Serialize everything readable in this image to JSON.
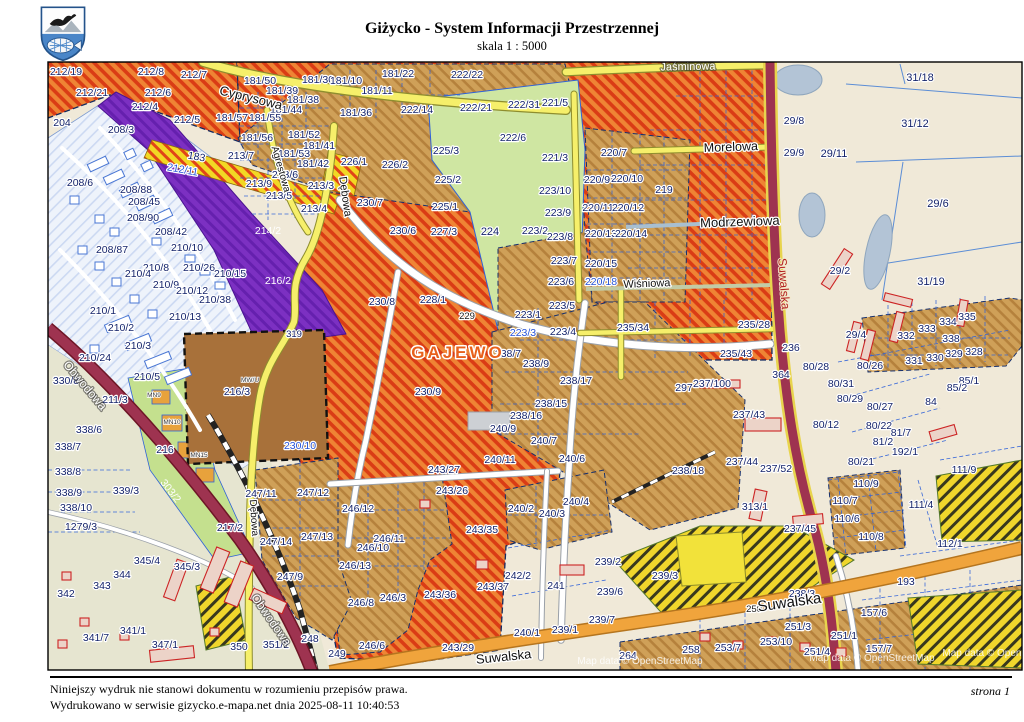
{
  "header": {
    "title": "Giżycko - System Informacji Przestrzennej",
    "subtitle": "skala 1 : 5000"
  },
  "footer": {
    "line1": "Niniejszy wydruk nie stanowi dokumentu w rozumieniu przepisów prawa.",
    "line2": "Wydrukowano w serwisie gizycko.e-mapa.net dnia 2025-08-11 10:40:53",
    "page": "strona 1"
  },
  "map": {
    "watermark": "Map data © OpenStreetMap",
    "palette": {
      "red_hatch_bg": "#ef8434",
      "red_hatch_line": "#da3c15",
      "tan_bg": "#cfa058",
      "tan_line": "#b5813c",
      "green_area": "#cfe6a2",
      "purple_area": "#7c30c2",
      "brown_area": "#a8713a",
      "beige_area": "#f0e9d8",
      "residential_area": "#eef3fb",
      "water": "#b3c4d6",
      "yellow_road": "#f6ef6a",
      "maroon_road": "#9e3350",
      "orange_road": "#f0a43c",
      "yellow_black": "#f0d62c",
      "parcel_text": "#15246b",
      "blue_text": "#2753d6",
      "locality_text": "#e8611c",
      "suwalska_text": "#b32020"
    },
    "streets": [
      {
        "t": "Cyprysowa",
        "x": 250,
        "y": 102,
        "r": 14,
        "s": 13
      },
      {
        "t": "Jaśminowa",
        "x": 688,
        "y": 70,
        "r": -1,
        "s": 11,
        "c": "stw"
      },
      {
        "t": "Morelowa",
        "x": 731,
        "y": 151,
        "r": -2,
        "s": 12.5
      },
      {
        "t": "Modrzewiowa",
        "x": 740,
        "y": 226,
        "r": -2,
        "s": 13
      },
      {
        "t": "Wiśniowa",
        "x": 647,
        "y": 287,
        "r": -2,
        "s": 11
      },
      {
        "t": "Agrestowa",
        "x": 278,
        "y": 170,
        "r": 74,
        "s": 10
      },
      {
        "t": "Dębowa",
        "x": 342,
        "y": 197,
        "r": 82,
        "s": 11
      },
      {
        "t": "Dębowa",
        "x": 251,
        "y": 518,
        "r": 86,
        "s": 10
      },
      {
        "t": "Obwodowa",
        "x": 82,
        "y": 388,
        "r": 50,
        "s": 12,
        "c": "stw"
      },
      {
        "t": "Obwodowa",
        "x": 268,
        "y": 622,
        "r": 55,
        "s": 12,
        "c": "stw"
      },
      {
        "t": "Suwalska",
        "x": 780,
        "y": 284,
        "r": 86,
        "s": 12,
        "c": "str"
      },
      {
        "t": "Suwalska",
        "x": 790,
        "y": 607,
        "r": -8,
        "s": 15
      },
      {
        "t": "Suwalska",
        "x": 504,
        "y": 661,
        "r": -6,
        "s": 13
      },
      {
        "t": "GAJEWO",
        "x": 458,
        "y": 358,
        "s": 17,
        "c": "gaj",
        "ls": 3
      }
    ],
    "codes": [
      {
        "t": "MW/U",
        "x": 250,
        "y": 382
      },
      {
        "t": "MN9",
        "x": 154,
        "y": 397
      },
      {
        "t": "MN10",
        "x": 172,
        "y": 424
      },
      {
        "t": "MN15",
        "x": 199,
        "y": 457
      }
    ],
    "parcels": [
      {
        "t": "212/19",
        "x": 66,
        "y": 75
      },
      {
        "t": "212/8",
        "x": 151,
        "y": 75
      },
      {
        "t": "212/7",
        "x": 194,
        "y": 78
      },
      {
        "t": "212/21",
        "x": 92,
        "y": 96
      },
      {
        "t": "212/6",
        "x": 158,
        "y": 96
      },
      {
        "t": "212/4",
        "x": 145,
        "y": 110
      },
      {
        "t": "212/5",
        "x": 187,
        "y": 123
      },
      {
        "t": "204",
        "x": 62,
        "y": 126
      },
      {
        "t": "208/3",
        "x": 121,
        "y": 133
      },
      {
        "t": "181/50",
        "x": 260,
        "y": 84
      },
      {
        "t": "181/39",
        "x": 282,
        "y": 94
      },
      {
        "t": "181/38",
        "x": 303,
        "y": 103
      },
      {
        "t": "181/44",
        "x": 286,
        "y": 113
      },
      {
        "t": "181/57",
        "x": 232,
        "y": 121
      },
      {
        "t": "181/55",
        "x": 265,
        "y": 121
      },
      {
        "t": "181/56",
        "x": 257,
        "y": 141
      },
      {
        "t": "181/52",
        "x": 304,
        "y": 138
      },
      {
        "t": "181/53",
        "x": 294,
        "y": 157
      },
      {
        "t": "181/41",
        "x": 319,
        "y": 149
      },
      {
        "t": "181/42",
        "x": 313,
        "y": 167
      },
      {
        "t": "181/30",
        "x": 318,
        "y": 83
      },
      {
        "t": "181/10",
        "x": 346,
        "y": 84
      },
      {
        "t": "181/11",
        "x": 377,
        "y": 94
      },
      {
        "t": "181/36",
        "x": 356,
        "y": 116
      },
      {
        "t": "181/22",
        "x": 398,
        "y": 77
      },
      {
        "t": "213/7",
        "x": 241,
        "y": 159
      },
      {
        "t": "213/6",
        "x": 285,
        "y": 178
      },
      {
        "t": "213/9",
        "x": 259,
        "y": 187
      },
      {
        "t": "213/3",
        "x": 321,
        "y": 189
      },
      {
        "t": "213/5",
        "x": 279,
        "y": 199
      },
      {
        "t": "213/4",
        "x": 314,
        "y": 212
      },
      {
        "t": "183",
        "x": 196,
        "y": 160,
        "r": 10
      },
      {
        "t": "212/11",
        "x": 182,
        "y": 173,
        "c": "blue",
        "r": 10
      },
      {
        "t": "222/22",
        "x": 467,
        "y": 78
      },
      {
        "t": "222/14",
        "x": 417,
        "y": 113
      },
      {
        "t": "222/21",
        "x": 476,
        "y": 111
      },
      {
        "t": "222/31",
        "x": 524,
        "y": 108
      },
      {
        "t": "221/5",
        "x": 555,
        "y": 106
      },
      {
        "t": "222/6",
        "x": 513,
        "y": 141
      },
      {
        "t": "221/3",
        "x": 555,
        "y": 161
      },
      {
        "t": "220/7",
        "x": 614,
        "y": 156
      },
      {
        "t": "220/9",
        "x": 597,
        "y": 183
      },
      {
        "t": "220/10",
        "x": 627,
        "y": 182
      },
      {
        "t": "219",
        "x": 664,
        "y": 193
      },
      {
        "t": "220/11",
        "x": 598,
        "y": 211
      },
      {
        "t": "220/12",
        "x": 628,
        "y": 211
      },
      {
        "t": "220/13",
        "x": 601,
        "y": 237
      },
      {
        "t": "220/14",
        "x": 631,
        "y": 237
      },
      {
        "t": "220/15",
        "x": 601,
        "y": 267
      },
      {
        "t": "220/18",
        "x": 601,
        "y": 285,
        "c": "blue"
      },
      {
        "t": "31/18",
        "x": 920,
        "y": 81,
        "s": 11
      },
      {
        "t": "31/12",
        "x": 915,
        "y": 127,
        "s": 11
      },
      {
        "t": "29/11",
        "x": 834,
        "y": 157,
        "s": 11
      },
      {
        "t": "29/8",
        "x": 794,
        "y": 124
      },
      {
        "t": "29/9",
        "x": 794,
        "y": 156
      },
      {
        "t": "29/6",
        "x": 938,
        "y": 207,
        "s": 11
      },
      {
        "t": "31/19",
        "x": 931,
        "y": 285,
        "s": 11
      },
      {
        "t": "29/2",
        "x": 840,
        "y": 274
      },
      {
        "t": "29/4",
        "x": 856,
        "y": 338
      },
      {
        "t": "226/1",
        "x": 354,
        "y": 165
      },
      {
        "t": "226/2",
        "x": 395,
        "y": 168
      },
      {
        "t": "225/3",
        "x": 446,
        "y": 154
      },
      {
        "t": "225/2",
        "x": 448,
        "y": 183
      },
      {
        "t": "225/1",
        "x": 445,
        "y": 210
      },
      {
        "t": "227/3",
        "x": 444,
        "y": 235
      },
      {
        "t": "230/6",
        "x": 403,
        "y": 234
      },
      {
        "t": "230/7",
        "x": 370,
        "y": 206
      },
      {
        "t": "230/8",
        "x": 382,
        "y": 305
      },
      {
        "t": "230/9",
        "x": 428,
        "y": 395
      },
      {
        "t": "230/10",
        "x": 300,
        "y": 449,
        "c": "blue"
      },
      {
        "t": "228/1",
        "x": 433,
        "y": 303
      },
      {
        "t": "229",
        "x": 467,
        "y": 319,
        "c": "dark",
        "s": 9.5
      },
      {
        "t": "224",
        "x": 490,
        "y": 235,
        "s": 11
      },
      {
        "t": "223/2",
        "x": 535,
        "y": 234
      },
      {
        "t": "223/10",
        "x": 555,
        "y": 194
      },
      {
        "t": "223/9",
        "x": 558,
        "y": 216
      },
      {
        "t": "223/8",
        "x": 560,
        "y": 240
      },
      {
        "t": "223/7",
        "x": 564,
        "y": 264
      },
      {
        "t": "223/6",
        "x": 561,
        "y": 285
      },
      {
        "t": "223/5",
        "x": 562,
        "y": 309
      },
      {
        "t": "223/1",
        "x": 528,
        "y": 318
      },
      {
        "t": "223/3",
        "x": 523,
        "y": 336,
        "c": "blue"
      },
      {
        "t": "223/4",
        "x": 563,
        "y": 335
      },
      {
        "t": "214/2",
        "x": 268,
        "y": 234,
        "c": "white"
      },
      {
        "t": "216/2",
        "x": 278,
        "y": 284,
        "c": "white"
      },
      {
        "t": "216/3",
        "x": 237,
        "y": 395
      },
      {
        "t": "319",
        "x": 294,
        "y": 337,
        "s": 9.5
      },
      {
        "t": "216",
        "x": 165,
        "y": 453
      },
      {
        "t": "211/3",
        "x": 115,
        "y": 403
      },
      {
        "t": "210/8",
        "x": 156,
        "y": 271
      },
      {
        "t": "210/26",
        "x": 199,
        "y": 271
      },
      {
        "t": "210/15",
        "x": 230,
        "y": 277
      },
      {
        "t": "210/4",
        "x": 138,
        "y": 277
      },
      {
        "t": "210/9",
        "x": 166,
        "y": 288
      },
      {
        "t": "210/12",
        "x": 192,
        "y": 294
      },
      {
        "t": "210/38",
        "x": 215,
        "y": 303
      },
      {
        "t": "210/13",
        "x": 185,
        "y": 320
      },
      {
        "t": "210/1",
        "x": 103,
        "y": 314
      },
      {
        "t": "210/2",
        "x": 121,
        "y": 331
      },
      {
        "t": "210/3",
        "x": 138,
        "y": 349
      },
      {
        "t": "210/24",
        "x": 95,
        "y": 361
      },
      {
        "t": "210/5",
        "x": 147,
        "y": 380
      },
      {
        "t": "210/10",
        "x": 187,
        "y": 251
      },
      {
        "t": "208/6",
        "x": 80,
        "y": 186
      },
      {
        "t": "208/88",
        "x": 136,
        "y": 193
      },
      {
        "t": "208/45",
        "x": 144,
        "y": 205
      },
      {
        "t": "208/90",
        "x": 143,
        "y": 221
      },
      {
        "t": "208/42",
        "x": 171,
        "y": 235
      },
      {
        "t": "208/87",
        "x": 112,
        "y": 253
      },
      {
        "t": "330/8",
        "x": 66,
        "y": 384
      },
      {
        "t": "338/6",
        "x": 89,
        "y": 433
      },
      {
        "t": "338/7",
        "x": 68,
        "y": 450
      },
      {
        "t": "338/8",
        "x": 68,
        "y": 475
      },
      {
        "t": "338/9",
        "x": 69,
        "y": 496
      },
      {
        "t": "338/10",
        "x": 76,
        "y": 511
      },
      {
        "t": "1279/3",
        "x": 81,
        "y": 530
      },
      {
        "t": "339/3",
        "x": 126,
        "y": 494
      },
      {
        "t": "342",
        "x": 66,
        "y": 597
      },
      {
        "t": "343",
        "x": 102,
        "y": 589
      },
      {
        "t": "344",
        "x": 122,
        "y": 578
      },
      {
        "t": "345/4",
        "x": 147,
        "y": 564
      },
      {
        "t": "345/3",
        "x": 187,
        "y": 570
      },
      {
        "t": "341/1",
        "x": 133,
        "y": 634
      },
      {
        "t": "341/7",
        "x": 96,
        "y": 641
      },
      {
        "t": "347/1",
        "x": 165,
        "y": 648
      },
      {
        "t": "350",
        "x": 239,
        "y": 650
      },
      {
        "t": "351/2",
        "x": 276,
        "y": 648
      },
      {
        "t": "248",
        "x": 310,
        "y": 642
      },
      {
        "t": "217/2",
        "x": 230,
        "y": 531
      },
      {
        "t": "303/2",
        "x": 168,
        "y": 493,
        "c": "white",
        "r": 52
      },
      {
        "t": "247/11",
        "x": 261,
        "y": 497
      },
      {
        "t": "247/12",
        "x": 313,
        "y": 496
      },
      {
        "t": "247/14",
        "x": 276,
        "y": 545
      },
      {
        "t": "247/13",
        "x": 317,
        "y": 540
      },
      {
        "t": "247/9",
        "x": 290,
        "y": 580
      },
      {
        "t": "235/34",
        "x": 633,
        "y": 331
      },
      {
        "t": "235/28",
        "x": 754,
        "y": 328
      },
      {
        "t": "235/43",
        "x": 736,
        "y": 357
      },
      {
        "t": "236",
        "x": 791,
        "y": 351
      },
      {
        "t": "297",
        "x": 684,
        "y": 391
      },
      {
        "t": "237/100",
        "x": 712,
        "y": 387
      },
      {
        "t": "364",
        "x": 781,
        "y": 378
      },
      {
        "t": "237/43",
        "x": 749,
        "y": 418
      },
      {
        "t": "238/7",
        "x": 508,
        "y": 357
      },
      {
        "t": "238/9",
        "x": 536,
        "y": 367
      },
      {
        "t": "238/17",
        "x": 576,
        "y": 384
      },
      {
        "t": "238/15",
        "x": 551,
        "y": 407
      },
      {
        "t": "238/16",
        "x": 526,
        "y": 419
      },
      {
        "t": "240/9",
        "x": 503,
        "y": 432
      },
      {
        "t": "240/7",
        "x": 544,
        "y": 444
      },
      {
        "t": "240/11",
        "x": 500,
        "y": 463
      },
      {
        "t": "240/6",
        "x": 572,
        "y": 462
      },
      {
        "t": "238/18",
        "x": 688,
        "y": 474
      },
      {
        "t": "243/27",
        "x": 444,
        "y": 473
      },
      {
        "t": "243/26",
        "x": 452,
        "y": 494
      },
      {
        "t": "246/12",
        "x": 358,
        "y": 512
      },
      {
        "t": "246/11",
        "x": 389,
        "y": 542
      },
      {
        "t": "246/10",
        "x": 373,
        "y": 551
      },
      {
        "t": "246/13",
        "x": 355,
        "y": 569
      },
      {
        "t": "246/3",
        "x": 393,
        "y": 601
      },
      {
        "t": "246/8",
        "x": 361,
        "y": 606
      },
      {
        "t": "246/6",
        "x": 372,
        "y": 649
      },
      {
        "t": "249",
        "x": 337,
        "y": 657
      },
      {
        "t": "243/35",
        "x": 482,
        "y": 533
      },
      {
        "t": "243/36",
        "x": 440,
        "y": 598
      },
      {
        "t": "243/37",
        "x": 493,
        "y": 590
      },
      {
        "t": "243/29",
        "x": 458,
        "y": 651
      },
      {
        "t": "240/2",
        "x": 521,
        "y": 512
      },
      {
        "t": "240/3",
        "x": 552,
        "y": 517
      },
      {
        "t": "240/4",
        "x": 576,
        "y": 505
      },
      {
        "t": "242/2",
        "x": 518,
        "y": 579
      },
      {
        "t": "241",
        "x": 556,
        "y": 589
      },
      {
        "t": "240/1",
        "x": 527,
        "y": 636
      },
      {
        "t": "239/1",
        "x": 565,
        "y": 633
      },
      {
        "t": "239/7",
        "x": 602,
        "y": 623
      },
      {
        "t": "239/2",
        "x": 608,
        "y": 565
      },
      {
        "t": "239/3",
        "x": 665,
        "y": 579
      },
      {
        "t": "239/6",
        "x": 610,
        "y": 595
      },
      {
        "t": "237/44",
        "x": 742,
        "y": 465
      },
      {
        "t": "237/52",
        "x": 776,
        "y": 472
      },
      {
        "t": "313/1",
        "x": 755,
        "y": 510
      },
      {
        "t": "237/45",
        "x": 800,
        "y": 532
      },
      {
        "t": "238/3",
        "x": 802,
        "y": 597
      },
      {
        "t": "250",
        "x": 754,
        "y": 612,
        "c": "dark",
        "s": 9.5
      },
      {
        "t": "251/3",
        "x": 798,
        "y": 630
      },
      {
        "t": "251/1",
        "x": 844,
        "y": 639
      },
      {
        "t": "251/4",
        "x": 817,
        "y": 655
      },
      {
        "t": "253/7",
        "x": 728,
        "y": 651
      },
      {
        "t": "253/10",
        "x": 776,
        "y": 645
      },
      {
        "t": "258",
        "x": 691,
        "y": 653
      },
      {
        "t": "264",
        "x": 628,
        "y": 659
      },
      {
        "t": "80/28",
        "x": 816,
        "y": 370
      },
      {
        "t": "80/31",
        "x": 841,
        "y": 387
      },
      {
        "t": "80/26",
        "x": 870,
        "y": 369
      },
      {
        "t": "80/29",
        "x": 850,
        "y": 402
      },
      {
        "t": "80/27",
        "x": 880,
        "y": 410
      },
      {
        "t": "80/22",
        "x": 879,
        "y": 429
      },
      {
        "t": "80/12",
        "x": 826,
        "y": 428
      },
      {
        "t": "81/7",
        "x": 901,
        "y": 436
      },
      {
        "t": "81/2",
        "x": 883,
        "y": 445
      },
      {
        "t": "192/1",
        "x": 905,
        "y": 455
      },
      {
        "t": "80/21",
        "x": 861,
        "y": 465
      },
      {
        "t": "85/1",
        "x": 969,
        "y": 384
      },
      {
        "t": "85/2",
        "x": 957,
        "y": 391
      },
      {
        "t": "84",
        "x": 931,
        "y": 405
      },
      {
        "t": "111/9",
        "x": 964,
        "y": 473
      },
      {
        "t": "111/4",
        "x": 921,
        "y": 508
      },
      {
        "t": "110/9",
        "x": 866,
        "y": 487
      },
      {
        "t": "110/7",
        "x": 845,
        "y": 504
      },
      {
        "t": "110/6",
        "x": 847,
        "y": 522
      },
      {
        "t": "110/8",
        "x": 871,
        "y": 540
      },
      {
        "t": "112/1",
        "x": 950,
        "y": 547
      },
      {
        "t": "193",
        "x": 906,
        "y": 585
      },
      {
        "t": "157/6",
        "x": 874,
        "y": 616
      },
      {
        "t": "157/7",
        "x": 879,
        "y": 652
      },
      {
        "t": "332",
        "x": 906,
        "y": 339
      },
      {
        "t": "333",
        "x": 927,
        "y": 332
      },
      {
        "t": "334",
        "x": 948,
        "y": 325
      },
      {
        "t": "335",
        "x": 967,
        "y": 320
      },
      {
        "t": "338",
        "x": 951,
        "y": 342
      },
      {
        "t": "331",
        "x": 914,
        "y": 364
      },
      {
        "t": "330",
        "x": 935,
        "y": 361
      },
      {
        "t": "329",
        "x": 954,
        "y": 357
      },
      {
        "t": "328",
        "x": 974,
        "y": 355
      }
    ]
  }
}
